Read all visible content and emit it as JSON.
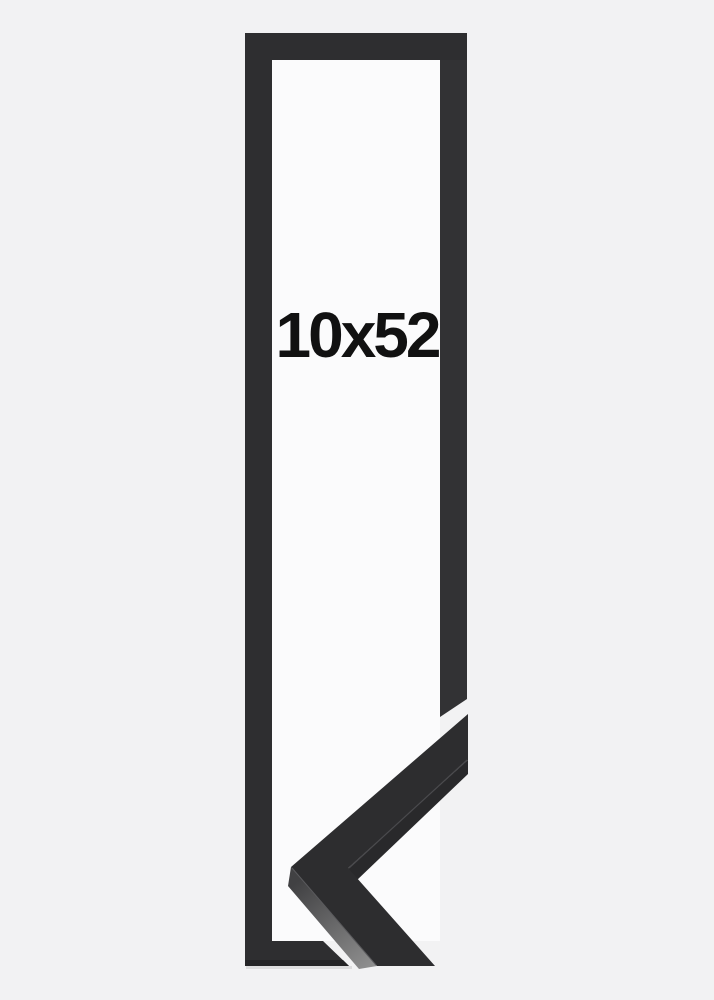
{
  "product": {
    "size_label": "10x52",
    "kind": "picture-frame-product-photo",
    "frame_color_name": "black"
  },
  "colors": {
    "background": "#f2f2f3",
    "inner_paper": "#fbfbfc",
    "frame": "#2e2e30",
    "frame_right_bar": "#323234",
    "corner_top_face": "#2d2d2f",
    "corner_underside": "#29292b",
    "side_face_dark": "#414143",
    "side_face_light": "#909090",
    "edge_highlight": "#4a4a4d",
    "outer_edge_highlight": "#5a5a5d",
    "bottom_bevel": "#232325",
    "drop_shadow": "#dcdcdd",
    "label_text": "#111111"
  }
}
